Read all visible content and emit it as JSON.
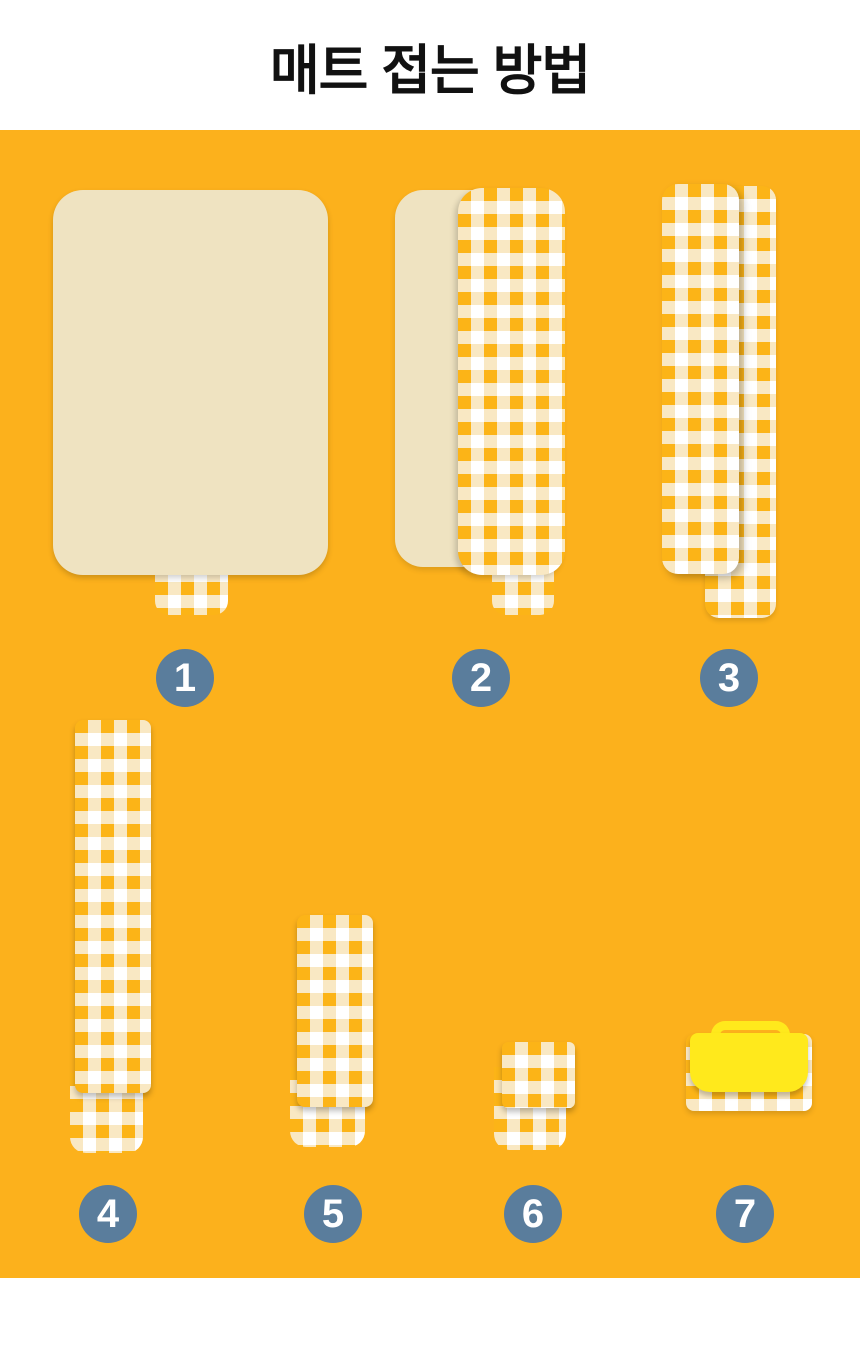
{
  "page": {
    "title": "매트 접는 방법"
  },
  "steps": [
    {
      "number": "1"
    },
    {
      "number": "2"
    },
    {
      "number": "3"
    },
    {
      "number": "4"
    },
    {
      "number": "5"
    },
    {
      "number": "6"
    },
    {
      "number": "7"
    }
  ],
  "colors": {
    "title_color": "#111111",
    "panel_orange": "#FCB11C",
    "mat_cream": "#EFE3C1",
    "gingham_orange": "#FCB417",
    "gingham_cream": "#F9E8C3",
    "gingham_white": "#FFFFFF",
    "badge_slate": "#5A7D9C",
    "badge_text": "#FFFFFF",
    "flap_yellow": "#FFE91C"
  }
}
